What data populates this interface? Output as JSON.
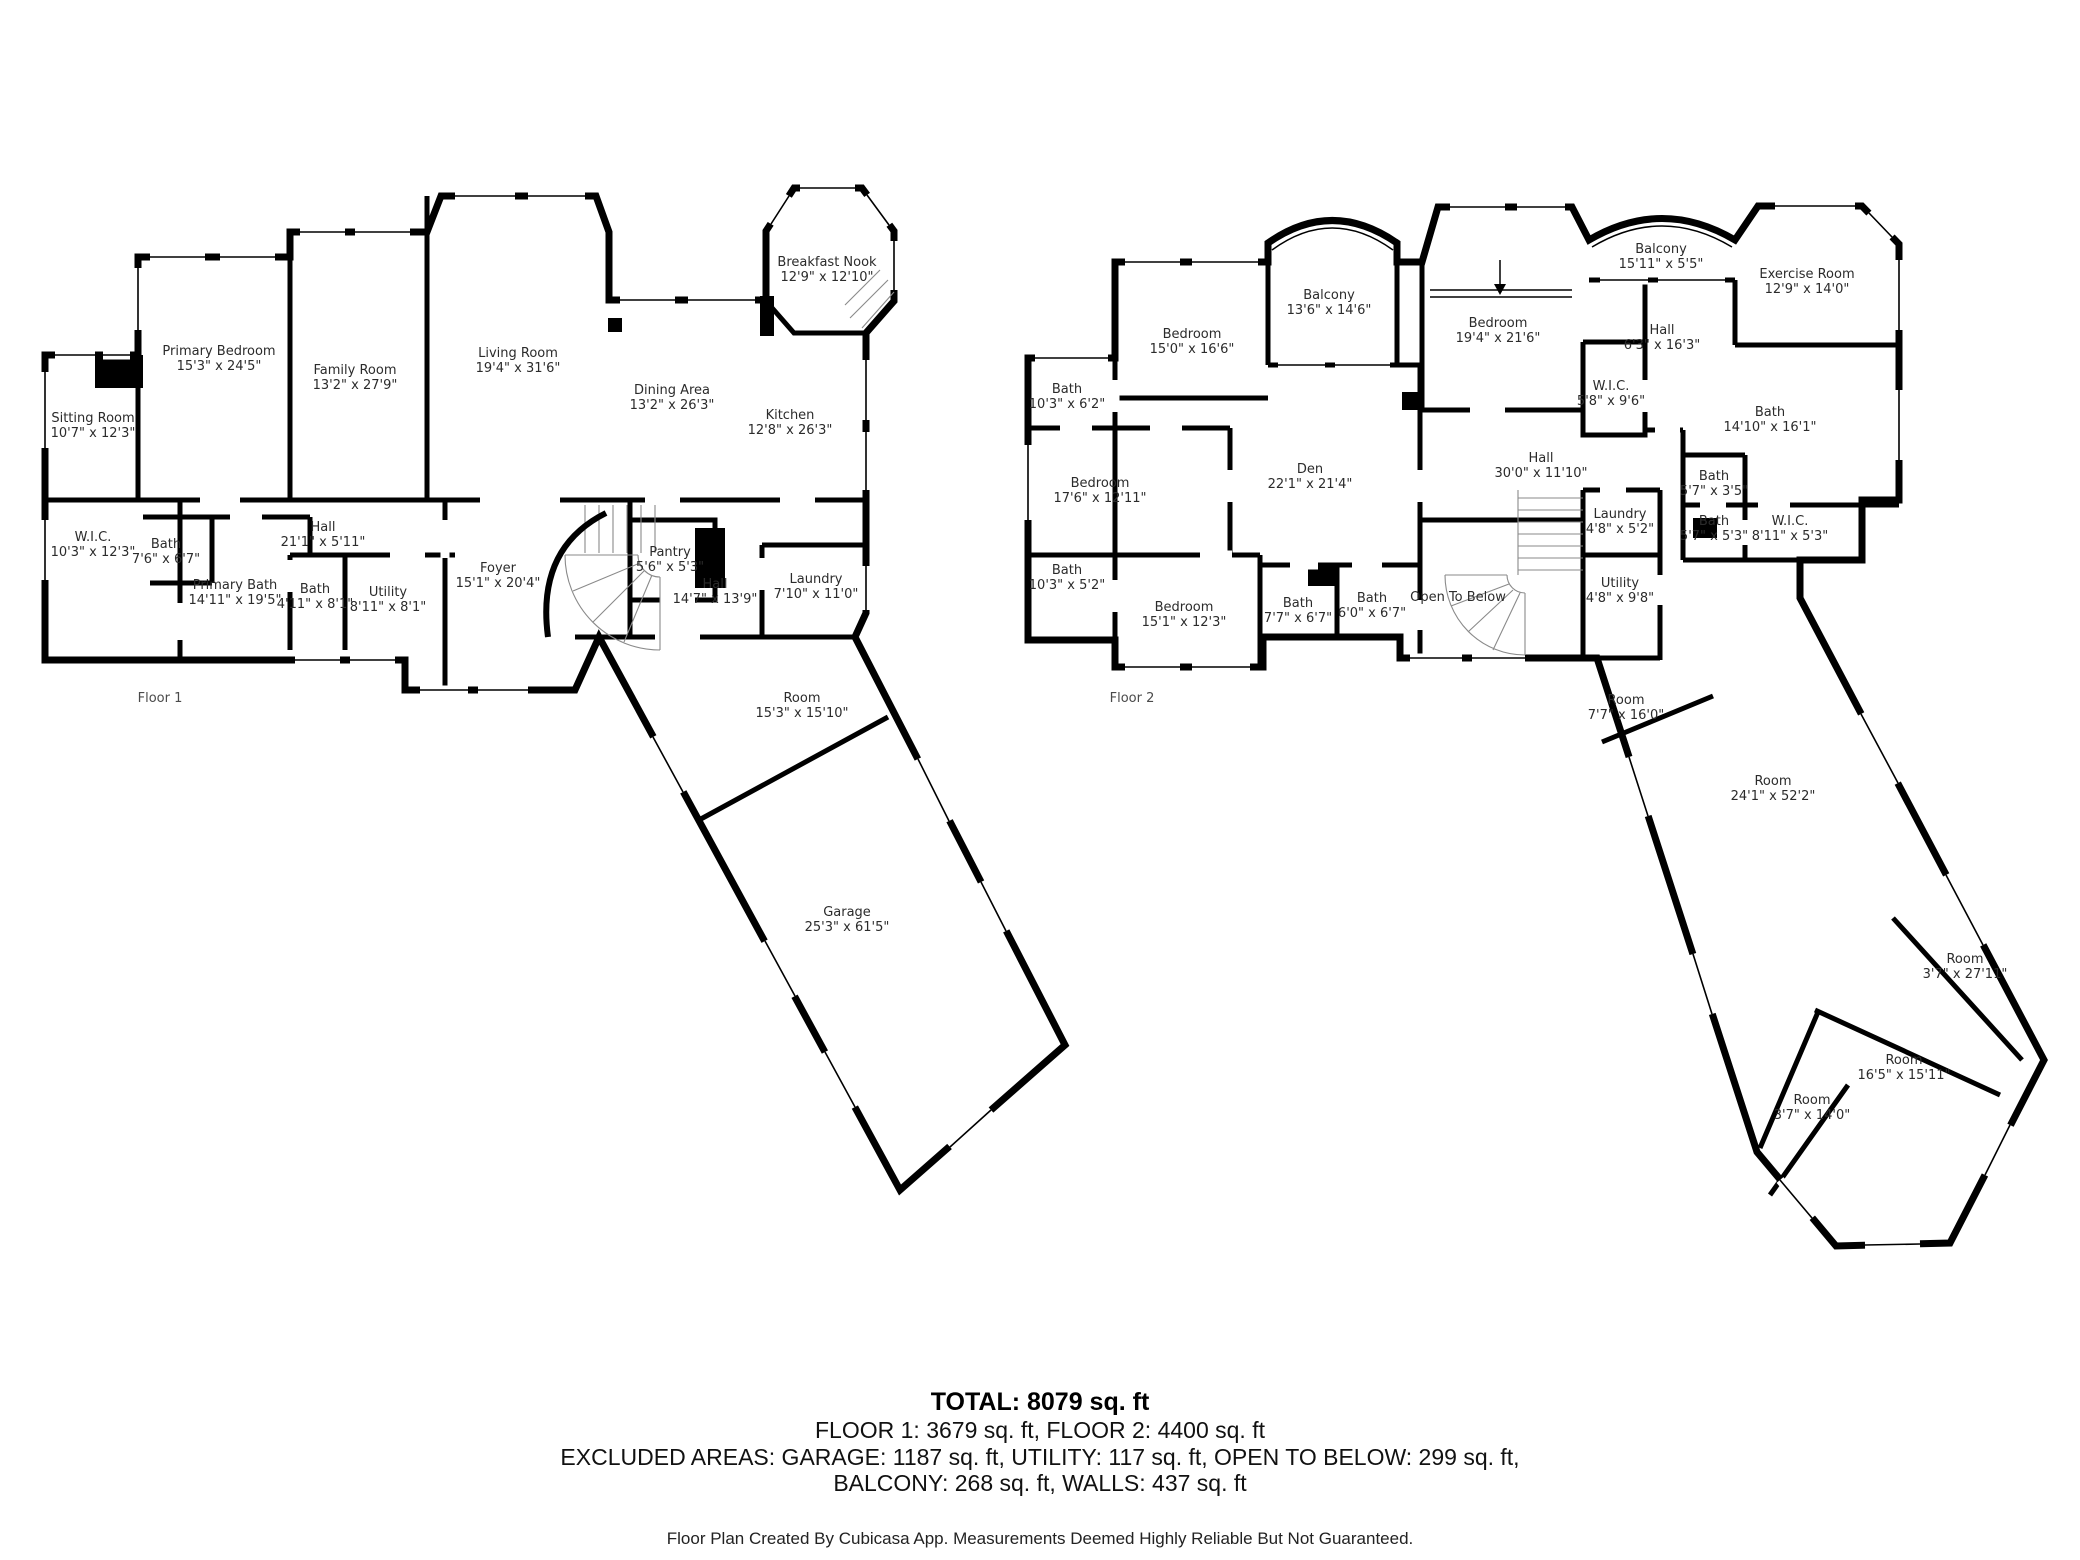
{
  "floor1": {
    "label": "Floor 1",
    "rooms": [
      {
        "name": "Sitting Room",
        "dims": "10'7\" x 12'3\""
      },
      {
        "name": "Primary Bedroom",
        "dims": "15'3\" x 24'5\""
      },
      {
        "name": "Family Room",
        "dims": "13'2\" x 27'9\""
      },
      {
        "name": "Living Room",
        "dims": "19'4\" x 31'6\""
      },
      {
        "name": "Breakfast Nook",
        "dims": "12'9\" x 12'10\""
      },
      {
        "name": "Dining Area",
        "dims": "13'2\" x 26'3\""
      },
      {
        "name": "Kitchen",
        "dims": "12'8\" x 26'3\""
      },
      {
        "name": "W.I.C.",
        "dims": "10'3\" x 12'3\""
      },
      {
        "name": "Bath",
        "dims": "7'6\" x 6'7\""
      },
      {
        "name": "Primary Bath",
        "dims": "14'11\" x 19'5\""
      },
      {
        "name": "Hall",
        "dims": "21'1\" x 5'11\""
      },
      {
        "name": "Bath",
        "dims": "4'11\" x 8'1\""
      },
      {
        "name": "Utility",
        "dims": "8'11\" x 8'1\""
      },
      {
        "name": "Foyer",
        "dims": "15'1\" x 20'4\""
      },
      {
        "name": "Pantry",
        "dims": "5'6\" x 5'3\""
      },
      {
        "name": "Hall",
        "dims": "14'7\" x 13'9\""
      },
      {
        "name": "Laundry",
        "dims": "7'10\" x 11'0\""
      },
      {
        "name": "Room",
        "dims": "15'3\" x 15'10\""
      },
      {
        "name": "Garage",
        "dims": "25'3\" x 61'5\""
      }
    ]
  },
  "floor2": {
    "label": "Floor 2",
    "rooms": [
      {
        "name": "Bedroom",
        "dims": "15'0\" x 16'6\""
      },
      {
        "name": "Balcony",
        "dims": "13'6\" x 14'6\""
      },
      {
        "name": "Bedroom",
        "dims": "19'4\" x 21'6\""
      },
      {
        "name": "Balcony",
        "dims": "15'11\" x 5'5\""
      },
      {
        "name": "Exercise Room",
        "dims": "12'9\" x 14'0\""
      },
      {
        "name": "Hall",
        "dims": "6'3\" x 16'3\""
      },
      {
        "name": "W.I.C.",
        "dims": "5'8\" x 9'6\""
      },
      {
        "name": "Bath",
        "dims": "14'10\" x 16'1\""
      },
      {
        "name": "Bath",
        "dims": "10'3\" x 6'2\""
      },
      {
        "name": "Bedroom",
        "dims": "17'6\" x 12'11\""
      },
      {
        "name": "Den",
        "dims": "22'1\" x 21'4\""
      },
      {
        "name": "Hall",
        "dims": "30'0\" x 11'10\""
      },
      {
        "name": "Bath",
        "dims": "5'7\" x 3'5\""
      },
      {
        "name": "Bath",
        "dims": "5'7\" x 5'3\""
      },
      {
        "name": "W.I.C.",
        "dims": "8'11\" x 5'3\""
      },
      {
        "name": "Laundry",
        "dims": "4'8\" x 5'2\""
      },
      {
        "name": "Utility",
        "dims": "4'8\" x 9'8\""
      },
      {
        "name": "Open To Below",
        "dims": ""
      },
      {
        "name": "Bath",
        "dims": "10'3\" x 5'2\""
      },
      {
        "name": "Bedroom",
        "dims": "15'1\" x 12'3\""
      },
      {
        "name": "Bath",
        "dims": "7'7\" x 6'7\""
      },
      {
        "name": "Bath",
        "dims": "6'0\" x 6'7\""
      },
      {
        "name": "Room",
        "dims": "7'7\" x 16'0\""
      },
      {
        "name": "Room",
        "dims": "24'1\" x 52'2\""
      },
      {
        "name": "Room",
        "dims": "3'7\" x 27'11\""
      },
      {
        "name": "Room",
        "dims": "16'5\" x 15'11\""
      },
      {
        "name": "Room",
        "dims": "3'7\" x 14'0\""
      }
    ]
  },
  "summary": {
    "total": "TOTAL: 8079 sq. ft",
    "floors": "FLOOR 1: 3679 sq. ft, FLOOR 2: 4400 sq. ft",
    "excluded1": "EXCLUDED AREAS: GARAGE: 1187 sq. ft, UTILITY: 117 sq. ft, OPEN TO BELOW: 299 sq. ft,",
    "excluded2": "BALCONY: 268 sq. ft, WALLS: 437 sq. ft"
  },
  "footer": "Floor Plan Created By Cubicasa App. Measurements Deemed Highly Reliable But Not Guaranteed.",
  "colors": {
    "walls": "#000000",
    "text": "#2b2b2b",
    "background": "#ffffff"
  }
}
